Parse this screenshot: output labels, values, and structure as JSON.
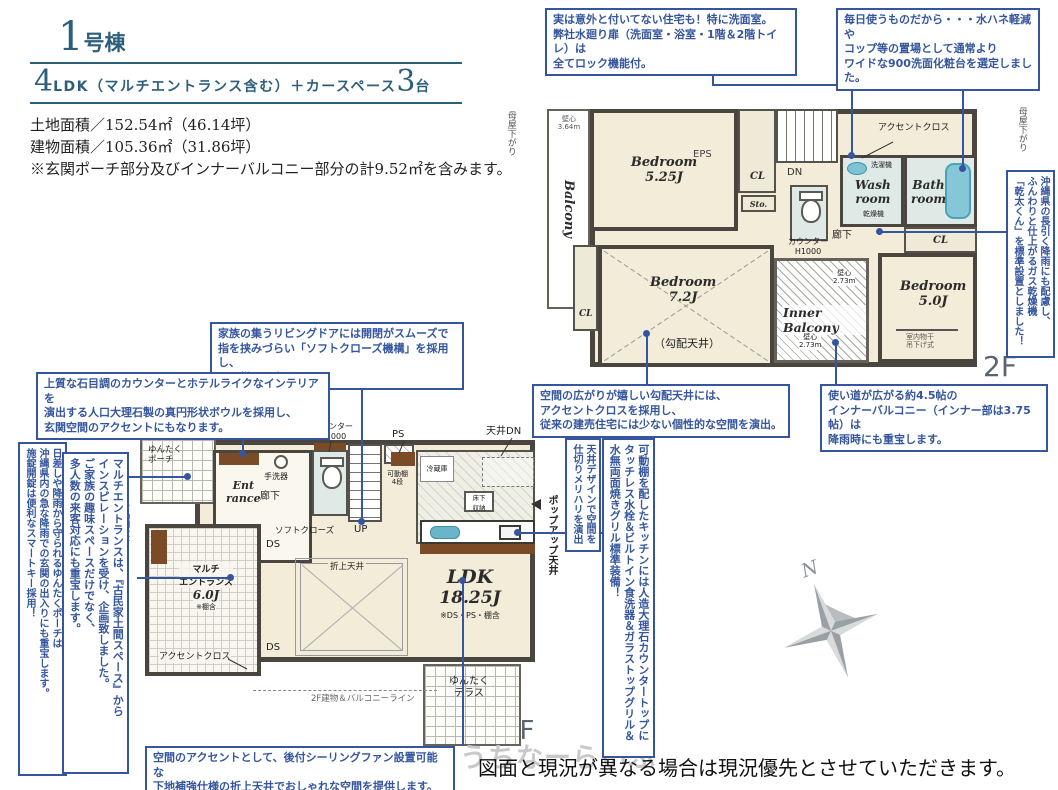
{
  "header": {
    "building_number": "1",
    "building_suffix": "号棟",
    "spec_num1": "4",
    "spec_mid": "LDK（マルチエントランス含む）＋カースペース",
    "spec_num2": "3",
    "spec_tail": "台",
    "land_area": "土地面積／152.54㎡（46.14坪）",
    "building_area": "建物面積／105.36㎡（31.86坪）",
    "area_note": "※玄関ポーチ部分及びインナーバルコニー部分の計9.52㎡を含みます。"
  },
  "callouts": {
    "lock": "実は意外と付いてない住宅も！特に洗面室。\n弊社水廻り扉（洗面室・浴室・1階＆2階トイレ）は\n全てロック機能付。",
    "vanity": "毎日使うものだから・・・水ハネ軽減や\nコップ等の置場として通常より\nワイドな900洗面化粧台を選定しました。",
    "gas_dryer": "沖縄県の長引く降雨にも配慮し、\nふんわりと仕上がるガス乾燥機\n「乾太くん」を標準設置としました！",
    "living_door": "家族の集うリビングドアには開閉がスムーズで\n指を挟みづらい「ソフトクローズ機構」を採用し、\nお子様にも安心です。",
    "bowl": "上質な石目調のカウンターとホテルライクなインテリアを\n演出する人口大理石製の真円形状ボウルを採用し、\n玄関空間のアクセントにもなります。",
    "slope_ceiling": "空間の広がりが嬉しい勾配天井には、\nアクセントクロスを採用し、\n従来の建売住宅には少ない個性的な空間を演出。",
    "inner_balcony": "使い道が広がる約4.5帖の\nインナーバルコニー（インナー部は3.75帖）は\n降雨時にも重宝します。",
    "porch": "日差しや降雨から守られるゆんたくポーチは\n沖縄県内の急な降雨での玄関の出入りにも重宝します。\n施錠開錠は便利なスマートキー採用！",
    "multi_entrance": "マルチエントランスは、『古民家土間スペース』から\nインスピレーションを受け、企画致しました。\nご家族の趣味スペースだけでなく、\n多人数の来客対応にも重宝します。",
    "ceiling_design": "天井デザインで空間を\n仕切りメリハリを演出",
    "popup_ceiling": "ポップアップ天井",
    "kitchen": "可動棚を配したキッチンには人造大理石カウンタートップに\nタッチレス水栓＆ビルトイン食洗器＆ガラストップグリル＆\n水無両面焼きグリル標準装備！",
    "ceiling_fan": "空間のアクセントとして、後付シーリングファン設置可能な\n下地補強仕様の折上天井でおしゃれな空間を提供します。"
  },
  "plan2f": {
    "floor_label": "2F",
    "moya_left": "母屋下がり",
    "moya_right": "母屋下がり",
    "balcony_label": "Balcony",
    "balcony_dim": "壁心\n3.64m",
    "bedroom1": "Bedroom\n5.25J",
    "eps": "EPS",
    "cl_top": "CL",
    "sto": "Sto.",
    "dn": "DN",
    "hallway": "廊下",
    "accent_cross": "アクセントクロス",
    "washer": "洗濯機",
    "washroom": "Wash\nroom",
    "dryer": "乾燥機",
    "bathroom": "Bath\nroom",
    "counter": "カウンター\nH1000",
    "cl_bath": "CL",
    "bedroom2": "Bedroom\n7.2J",
    "bedroom2_slope": "（勾配天井）",
    "cl_bed2": "CL",
    "inner_balcony": "Inner Balcony",
    "ib_dim1": "壁心\n2.73m",
    "ib_dim2": "壁心\n2.73m",
    "bedroom3": "Bedroom\n5.0J",
    "bedroom3_hang": "室内物干\n吊下げ式"
  },
  "plan1f": {
    "floor_label": "1F",
    "counter_label": "カウンター\nH1000",
    "ps": "PS",
    "ceiling_dn": "天井DN",
    "porch": "ゆんたく\nポーチ",
    "hand_basin": "手洗器",
    "entrance": "Ent\nrance",
    "hallway": "廊下",
    "soft_close": "ソフトクローズ",
    "up": "UP",
    "ds1": "DS",
    "ds2": "DS",
    "shelf_left": "可動棚4段",
    "multi_name": "マルチ\nエントランス",
    "multi_size": "6.0J",
    "multi_note": "※棚含",
    "accent_cross": "アクセントクロス",
    "fridge": "冷蔵庫",
    "shelf_kitchen": "可動棚\n4段",
    "floor_storage": "床下\n収納",
    "oriage": "折上天井",
    "ldk_name": "LDK",
    "ldk_size": "18.25J",
    "ldk_note": "※DS・PS・棚含",
    "line_2f": "2F建物＆バルコニーライン",
    "terrace": "ゆんたく\nテラス"
  },
  "compass_n": "N",
  "footer": {
    "watermark": "うちなーらいふ",
    "disclaimer": "図面と現況が異なる場合は現況優先とさせていただきます。"
  },
  "colors": {
    "accent_blue": "#35569e",
    "header_blue": "#2d5f7d",
    "wall_gray": "#4a463f",
    "room_cream": "#f2ecd8",
    "wet_room": "#dfe9e6",
    "water_blue": "#6ab5c9",
    "wood_brown": "#7b4a26"
  }
}
